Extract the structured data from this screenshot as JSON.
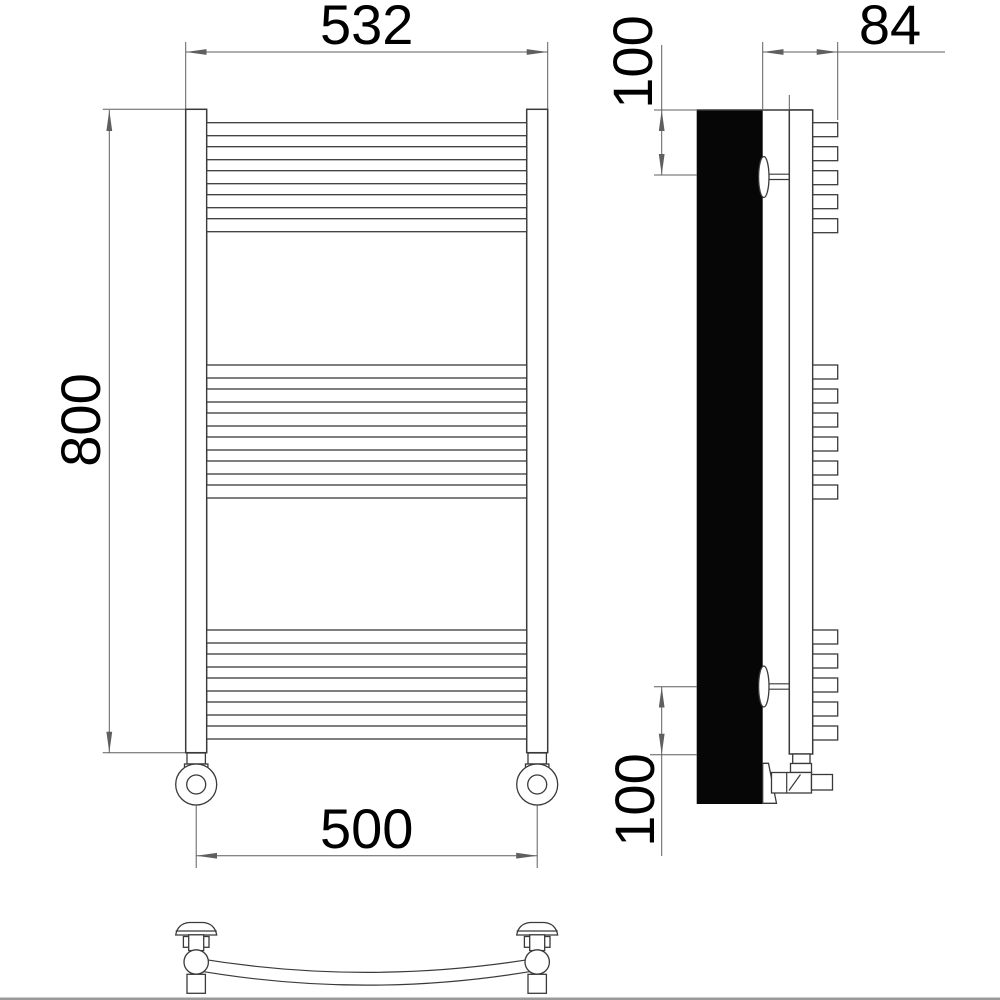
{
  "page": {
    "background": "#ffffff",
    "bottom_edge_color": "#9a9a9a"
  },
  "drawing": {
    "type": "technical-drawing",
    "subject": "curved ladder towel-rail radiator shown in front, side and bottom views",
    "dimensions": {
      "front_width": "532",
      "front_height": "800",
      "connection_spacing": "500",
      "side_depth": "84",
      "top_bracket_offset": "100",
      "bottom_bracket_offset": "100"
    },
    "geometry": {
      "tube_x": 206.7,
      "tube_w": 320,
      "tube_h": 13,
      "tube_pitch": 24,
      "tube_groups": [
        {
          "count": 5,
          "y_start": 122.7
        },
        {
          "count": 6,
          "y_start": 365
        },
        {
          "count": 5,
          "y_start": 630
        }
      ],
      "tab_x": 812.7,
      "tab_w": 25,
      "tab_h": 14
    },
    "colors": {
      "outline": "#3a3a3a",
      "dimension": "#5f5f5f",
      "text": "#000000",
      "profile_fill": "#060606"
    }
  }
}
